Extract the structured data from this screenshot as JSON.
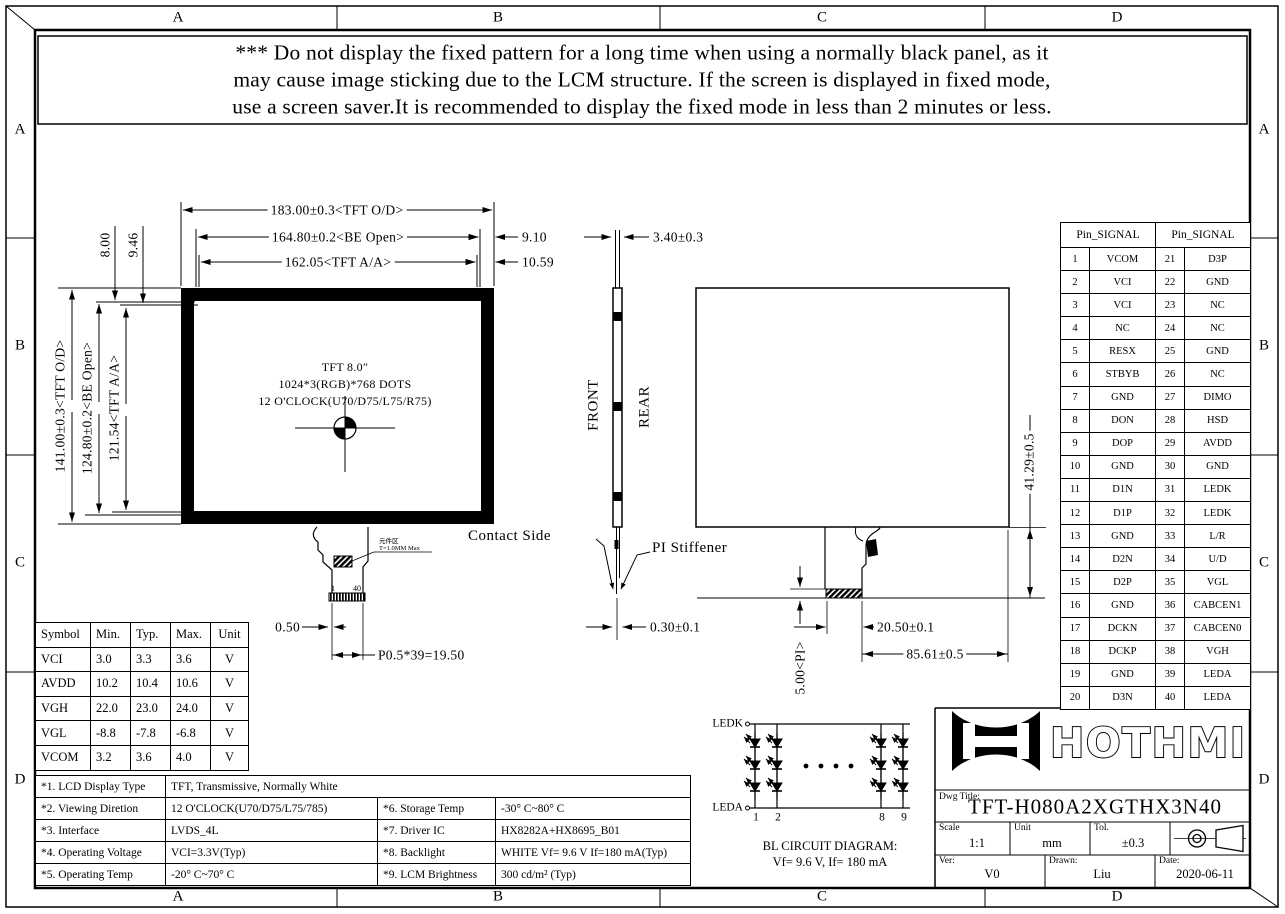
{
  "zones": {
    "top": [
      "A",
      "B",
      "C",
      "D"
    ],
    "bottom": [
      "A",
      "B",
      "C",
      "D"
    ],
    "left": [
      "A",
      "B",
      "C",
      "D"
    ],
    "right": [
      "A",
      "B",
      "C",
      "D"
    ]
  },
  "warning": {
    "line1": "*** Do not display the fixed pattern for a long time when using a normally black panel, as it",
    "line2": "may cause image sticking due to the LCM structure. If the screen is displayed in fixed mode,",
    "line3": "use a screen saver.It is recommended to display the fixed mode in less than 2 minutes or less."
  },
  "front_view": {
    "line1": "TFT 8.0″",
    "line2": "1024*3(RGB)*768 DOTS",
    "line3": "12 O'CLOCK(U70/D75/L75/R75)"
  },
  "labels": {
    "front": "FRONT",
    "rear": "REAR",
    "contact_side": "Contact Side",
    "pi_stiffener": "PI Stiffener"
  },
  "dims": {
    "top_od": "183.00±0.3<TFT O/D>",
    "top_be": "164.80±0.2<BE Open>",
    "top_aa": "162.05<TFT A/A>",
    "right_be_offset": "9.10",
    "right_aa_offset": "10.59",
    "left_offset_be": "8.00",
    "left_offset_aa": "9.46",
    "left_od": "141.00±0.3<TFT O/D>",
    "left_be": "124.80±0.2<BE Open>",
    "left_aa": "121.54<TFT A/A>",
    "thickness": "3.40±0.3",
    "fpc_edge": "0.50",
    "fpc_pitch": "P0.5*39=19.50",
    "fpc_thickness": "0.30±0.1",
    "pi_height": "5.00<PI>",
    "stiffener_width": "20.50±0.1",
    "fpc_width": "85.61±0.5",
    "fpc_length": "41.29±0.5",
    "pin_first": "1",
    "pin_last": "40",
    "component_note1": "元件区",
    "component_note2": "T=1.0MM Max"
  },
  "pin_table": {
    "header": "Pin_SIGNAL",
    "rows": [
      {
        "pin": "1",
        "signal": "VCOM",
        "pin2": "21",
        "signal2": "D3P"
      },
      {
        "pin": "2",
        "signal": "VCI",
        "pin2": "22",
        "signal2": "GND"
      },
      {
        "pin": "3",
        "signal": "VCI",
        "pin2": "23",
        "signal2": "NC"
      },
      {
        "pin": "4",
        "signal": "NC",
        "pin2": "24",
        "signal2": "NC"
      },
      {
        "pin": "5",
        "signal": "RESX",
        "pin2": "25",
        "signal2": "GND"
      },
      {
        "pin": "6",
        "signal": "STBYB",
        "pin2": "26",
        "signal2": "NC"
      },
      {
        "pin": "7",
        "signal": "GND",
        "pin2": "27",
        "signal2": "DIMO"
      },
      {
        "pin": "8",
        "signal": "DON",
        "pin2": "28",
        "signal2": "HSD"
      },
      {
        "pin": "9",
        "signal": "DOP",
        "pin2": "29",
        "signal2": "AVDD"
      },
      {
        "pin": "10",
        "signal": "GND",
        "pin2": "30",
        "signal2": "GND"
      },
      {
        "pin": "11",
        "signal": "D1N",
        "pin2": "31",
        "signal2": "LEDK"
      },
      {
        "pin": "12",
        "signal": "D1P",
        "pin2": "32",
        "signal2": "LEDK"
      },
      {
        "pin": "13",
        "signal": "GND",
        "pin2": "33",
        "signal2": "L/R"
      },
      {
        "pin": "14",
        "signal": "D2N",
        "pin2": "34",
        "signal2": "U/D"
      },
      {
        "pin": "15",
        "signal": "D2P",
        "pin2": "35",
        "signal2": "VGL"
      },
      {
        "pin": "16",
        "signal": "GND",
        "pin2": "36",
        "signal2": "CABCEN1"
      },
      {
        "pin": "17",
        "signal": "DCKN",
        "pin2": "37",
        "signal2": "CABCEN0"
      },
      {
        "pin": "18",
        "signal": "DCKP",
        "pin2": "38",
        "signal2": "VGH"
      },
      {
        "pin": "19",
        "signal": "GND",
        "pin2": "39",
        "signal2": "LEDA"
      },
      {
        "pin": "20",
        "signal": "D3N",
        "pin2": "40",
        "signal2": "LEDA"
      }
    ]
  },
  "electrical_table": {
    "headers": [
      "Symbol",
      "Min.",
      "Typ.",
      "Max.",
      "Unit"
    ],
    "rows": [
      [
        "VCI",
        "3.0",
        "3.3",
        "3.6",
        "V"
      ],
      [
        "AVDD",
        "10.2",
        "10.4",
        "10.6",
        "V"
      ],
      [
        "VGH",
        "22.0",
        "23.0",
        "24.0",
        "V"
      ],
      [
        "VGL",
        "-8.8",
        "-7.8",
        "-6.8",
        "V"
      ],
      [
        "VCOM",
        "3.2",
        "3.6",
        "4.0",
        "V"
      ]
    ]
  },
  "spec_table": {
    "rows": [
      [
        "*1. LCD Display Type",
        "TFT, Transmissive, Normally White"
      ],
      [
        "*2. Viewing Diretion",
        "12 O'CLOCK(U70/D75/L75/785)",
        "*6. Storage Temp",
        "-30° C~80° C"
      ],
      [
        "*3. Interface",
        "LVDS_4L",
        "*7. Driver IC",
        "HX8282A+HX8695_B01"
      ],
      [
        "*4. Operating Voltage",
        "VCI=3.3V(Typ)",
        "*8. Backlight",
        "WHITE Vf= 9.6 V If=180 mA(Typ)"
      ],
      [
        "*5. Operating Temp",
        "-20° C~70° C",
        "*9. LCM Brightness",
        "300 cd/m² (Typ)"
      ]
    ]
  },
  "bl_circuit": {
    "ledk": "LEDK",
    "leda": "LEDA",
    "col_labels": [
      "1",
      "2",
      "8",
      "9"
    ],
    "caption1": "BL CIRCUIT DIAGRAM:",
    "caption2": "Vf= 9.6 V, If= 180 mA"
  },
  "title_block": {
    "logo": "HOTHMI",
    "dwg_title_label": "Dwg Title:",
    "dwg_title": "TFT-H080A2XGTHX3N40",
    "scale_label": "Scale",
    "scale": "1:1",
    "unit_label": "Unit",
    "unit": "mm",
    "tol_label": "Tol.",
    "tol": "±0.3",
    "ver_label": "Ver:",
    "ver": "V0",
    "drawn_label": "Drawn:",
    "drawn": "Liu",
    "date_label": "Date:",
    "date": "2020-06-11"
  },
  "colors": {
    "ink": "#000000",
    "paper": "#ffffff"
  }
}
